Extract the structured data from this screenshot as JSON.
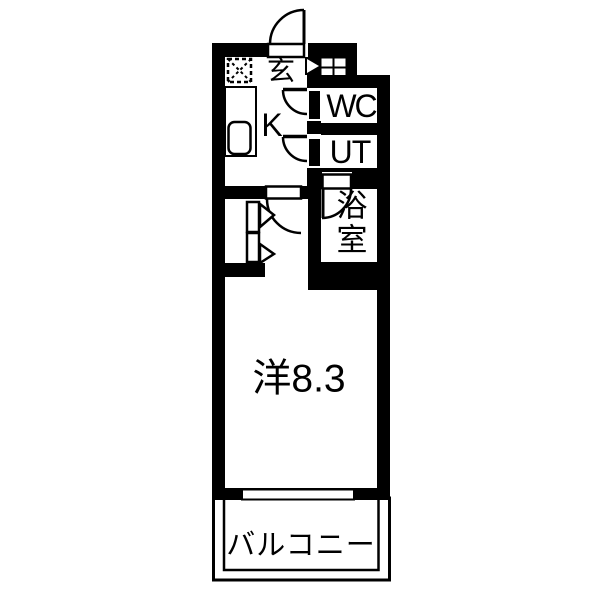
{
  "plan": {
    "type": "apartment-floor-plan",
    "colors": {
      "wall": "#000000",
      "floor": "#ffffff",
      "line": "#000000"
    },
    "rooms": {
      "genkan": {
        "label": "玄"
      },
      "kitchen": {
        "label": "K"
      },
      "wc": {
        "label": "WC"
      },
      "utility": {
        "label": "UT"
      },
      "bathroom": {
        "label": "浴室"
      },
      "western_room": {
        "label": "洋8.3",
        "area_value": "8.3"
      },
      "balcony": {
        "label": "バルコニー"
      }
    },
    "fixtures": [
      "entrance-door-swing",
      "shoe-cabinet",
      "refrigerator-space",
      "kitchen-counter",
      "kitchen-sink",
      "wc-door-swing",
      "ut-door-swing",
      "bathroom-door-swing",
      "room-door-swing",
      "closet-folding-doors",
      "balcony-window",
      "balcony-railing"
    ]
  }
}
